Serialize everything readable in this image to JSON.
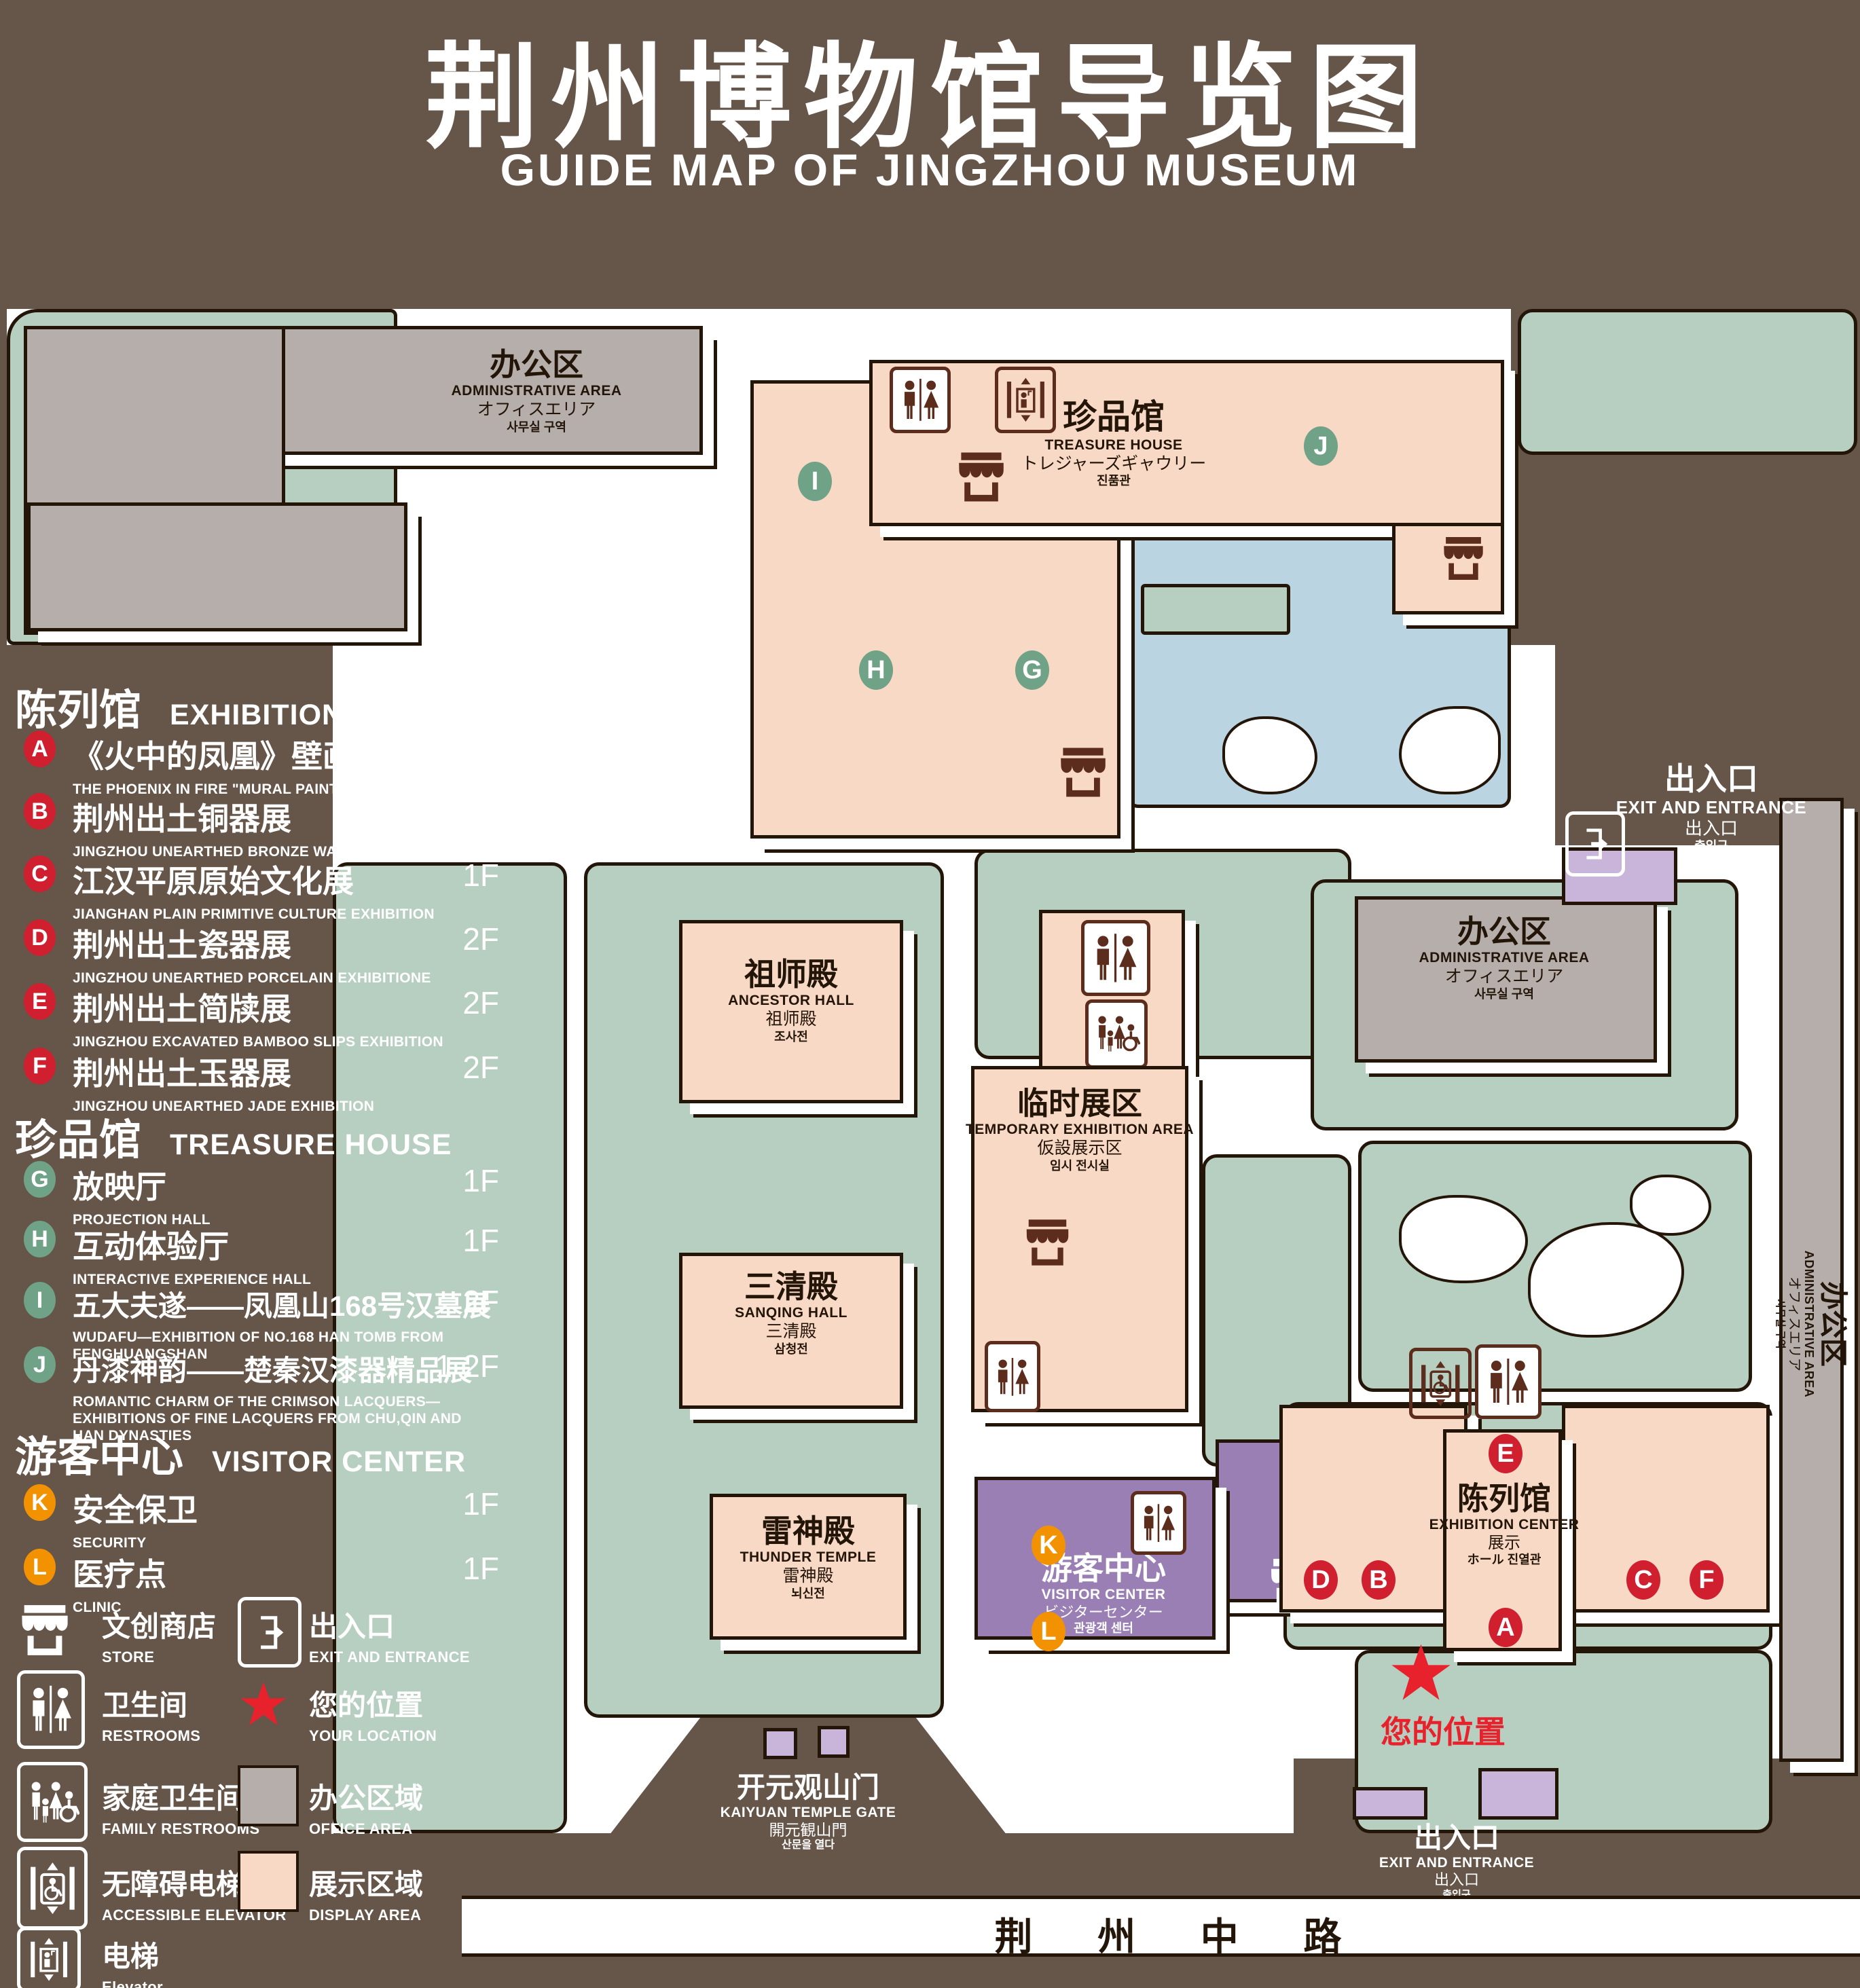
{
  "title": {
    "zh": "荆州博物馆导览图",
    "en": "GUIDE MAP OF JINGZHOU MUSEUM"
  },
  "legend": {
    "sections": [
      {
        "zh": "陈列馆",
        "en": "EXHIBITION CENTER",
        "items": [
          {
            "letter": "A",
            "zh": "《火中的凤凰》壁画",
            "en": "THE PHOENIX IN FIRE \"MURAL PAINTING",
            "floor": "1F"
          },
          {
            "letter": "B",
            "zh": "荆州出土铜器展",
            "en": "JINGZHOU UNEARTHED BRONZE WARE EXHIBITION",
            "floor": "1F"
          },
          {
            "letter": "C",
            "zh": "江汉平原原始文化展",
            "en": "JIANGHAN PLAIN PRIMITIVE CULTURE EXHIBITION",
            "floor": "1F"
          },
          {
            "letter": "D",
            "zh": "荆州出土瓷器展",
            "en": "JINGZHOU UNEARTHED PORCELAIN EXHIBITIONE",
            "floor": "2F"
          },
          {
            "letter": "E",
            "zh": "荆州出土简牍展",
            "en": "JINGZHOU EXCAVATED BAMBOO SLIPS EXHIBITION",
            "floor": "2F"
          },
          {
            "letter": "F",
            "zh": "荆州出土玉器展",
            "en": "JINGZHOU UNEARTHED JADE EXHIBITION",
            "floor": "2F"
          }
        ]
      },
      {
        "zh": "珍品馆",
        "en": "TREASURE HOUSE",
        "items": [
          {
            "letter": "G",
            "zh": "放映厅",
            "en": "PROJECTION HALL",
            "floor": "1F"
          },
          {
            "letter": "H",
            "zh": "互动体验厅",
            "en": "INTERACTIVE EXPERIENCE HALL",
            "floor": "1F"
          },
          {
            "letter": "I",
            "zh": "五大夫遂——凤凰山168号汉墓展",
            "en": "WUDAFU—EXHIBITION OF NO.168 HAN TOMB FROM FENGHUANGSHAN",
            "floor": "2F"
          },
          {
            "letter": "J",
            "zh": "丹漆神韵——楚秦汉漆器精品展",
            "en": "ROMANTIC CHARM OF THE CRIMSON LACQUERS—EXHIBITIONS OF FINE LACQUERS FROM CHU,QIN AND HAN DYNASTIES",
            "floor": "1-2F"
          }
        ]
      },
      {
        "zh": "游客中心",
        "en": "VISITOR CENTER",
        "items": [
          {
            "letter": "K",
            "zh": "安全保卫",
            "en": "SECURITY",
            "floor": "1F"
          },
          {
            "letter": "L",
            "zh": "医疗点",
            "en": "CLINIC",
            "floor": "1F"
          }
        ]
      }
    ],
    "symbols": [
      {
        "icon": "store-icon",
        "zh": "文创商店",
        "en": "STORE"
      },
      {
        "icon": "exit-icon",
        "zh": "出入口",
        "en": "EXIT AND ENTRANCE"
      },
      {
        "icon": "restroom-icon",
        "zh": "卫生间",
        "en": "RESTROOMS"
      },
      {
        "icon": "location-star-icon",
        "zh": "您的位置",
        "en": "YOUR LOCATION"
      },
      {
        "icon": "family-restroom-icon",
        "zh": "家庭卫生间",
        "en": "FAMILY RESTROOMS"
      },
      {
        "icon": "office-area-swatch",
        "zh": "办公区域",
        "en": "OFFICE AREA"
      },
      {
        "icon": "accessible-elevator-icon",
        "zh": "无障碍电梯",
        "en": "ACCESSIBLE ELEVATOR"
      },
      {
        "icon": "display-area-swatch",
        "zh": "展示区域",
        "en": "DISPLAY AREA"
      },
      {
        "icon": "elevator-icon",
        "zh": "电梯",
        "en": "Elevator"
      }
    ]
  },
  "map": {
    "buildings": {
      "admin_nw": {
        "zh": "办公区",
        "en": "ADMINISTRATIVE AREA",
        "jp": "オフィスエリア",
        "kr": "사무실 구역"
      },
      "treasure_house": {
        "zh": "珍品馆",
        "en": "TREASURE HOUSE",
        "jp": "トレジャーズギャウリー",
        "kr": "진품관"
      },
      "ancestor_hall": {
        "zh": "祖师殿",
        "en": "ANCESTOR HALL",
        "jp": "祖师殿",
        "kr": "조사전"
      },
      "temporary_exhibition": {
        "zh": "临时展区",
        "en": "TEMPORARY EXHIBITION AREA",
        "jp": "仮設展示区",
        "kr": "임시 전시실"
      },
      "admin_center": {
        "zh": "办公区",
        "en": "ADMINISTRATIVE AREA",
        "jp": "オフィスエリア",
        "kr": "사무실 구역"
      },
      "admin_east": {
        "zh": "办公区",
        "en": "ADMINISTRATIVE AREA",
        "jp": "オフィスエリア",
        "kr": "사무실 구역"
      },
      "sanqing_hall": {
        "zh": "三清殿",
        "en": "SANQING HALL",
        "jp": "三清殿",
        "kr": "삼청전"
      },
      "thunder_temple": {
        "zh": "雷神殿",
        "en": "THUNDER TEMPLE",
        "jp": "雷神殿",
        "kr": "뇌신전"
      },
      "exhibition_center": {
        "zh": "陈列馆",
        "en": "EXHIBITION CENTER",
        "jp": "展示",
        "line4": "ホール 진열관"
      },
      "visitor_center": {
        "zh": "游客中心",
        "en": "VISITOR CENTER",
        "jp": "ビジターセンター",
        "kr": "관광객 센터"
      }
    },
    "gates": {
      "east_exit": {
        "zh": "出入口",
        "en": "EXIT AND ENTRANCE",
        "jp": "出入口",
        "kr": "출입구"
      },
      "south_exit": {
        "zh": "出入口",
        "en": "EXIT AND ENTRANCE",
        "jp": "出入口",
        "kr": "출입구"
      },
      "kaiyuan_gate": {
        "zh": "开元观山门",
        "en": "KAIYUAN TEMPLE GATE",
        "jp": "開元観山門",
        "kr": "산문을 열다"
      }
    },
    "road": {
      "name": "荆 州 中 路"
    },
    "your_location": {
      "zh": "您的位置"
    },
    "marker_letters": {
      "A": "A",
      "B": "B",
      "C": "C",
      "D": "D",
      "E": "E",
      "F": "F",
      "G": "G",
      "H": "H",
      "I": "I",
      "J": "J",
      "K": "K",
      "L": "L"
    }
  },
  "colors": {
    "background": "#665549",
    "lawn": "#b7cfc0",
    "display_area": "#f8d9c5",
    "office_area": "#b5aeab",
    "visitor_center": "#9a7fb5",
    "entrance_block": "#c9b4da",
    "pond": "#bad4e2",
    "marker_red": "#d01f2f",
    "marker_green": "#6fa287",
    "marker_orange": "#f39200",
    "your_location_red": "#e8222d",
    "icon_brown": "#5c2c1d"
  }
}
